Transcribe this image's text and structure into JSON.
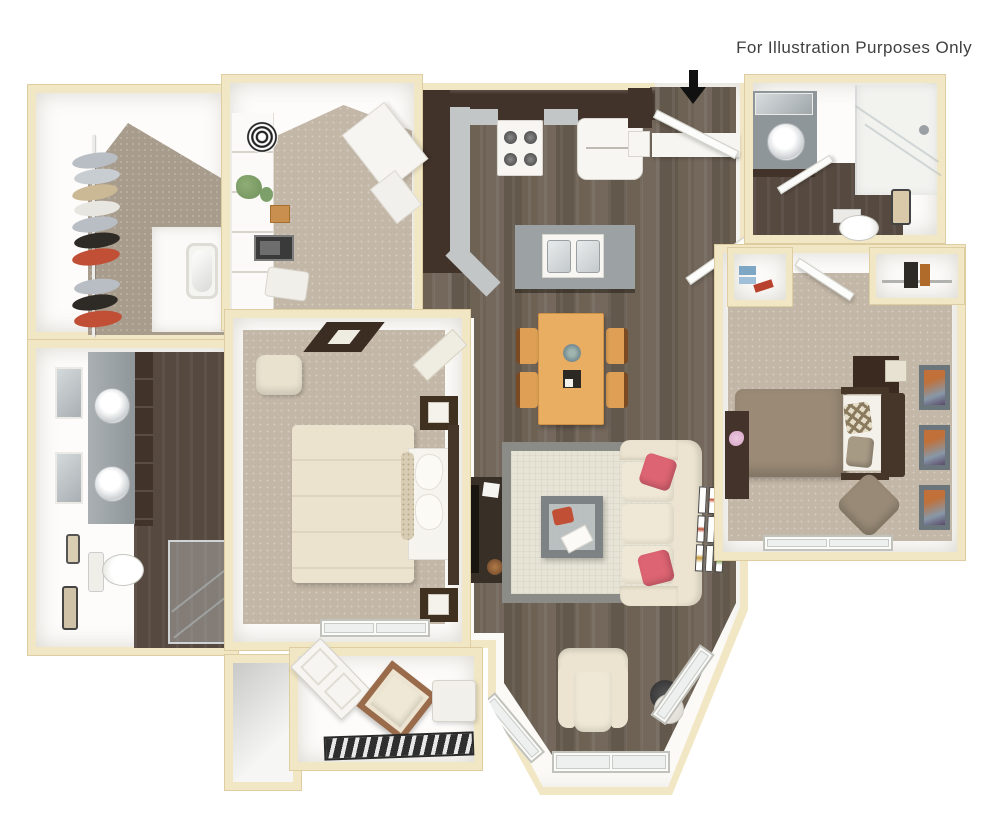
{
  "caption": {
    "text": "For Illustration Purposes Only"
  },
  "palette": {
    "wall": "#f2e7c5",
    "wall_edge": "#ddcda0",
    "wood": "#6e6255",
    "bath_floor": "#564940",
    "carpet": "#c3b7a7",
    "carpet_dark": "#a89c8d",
    "cabinet": "#41332a",
    "counter": "#c3c6c6",
    "island": "#9ca1a4",
    "steel": "#8f969a",
    "table_wood": "#e9ae62",
    "chair_wood": "#dfa055",
    "sofa": "#ece4d0",
    "cushion": "#efe8d6",
    "pillow": "#dd6472",
    "rug_field": "#e7e4d6",
    "rug_border": "#8b8b87",
    "bed1": "#ece3cf",
    "bed2": "#9a8a76",
    "head_dark": "#46362a",
    "frame": "#6b757c",
    "art": "#c07038",
    "accent_red": "#c14f35",
    "plant": "#6f8f5a",
    "mat_dark": "#2f2f2f",
    "arrow_black": "#111111",
    "text": "#3f3f3f"
  },
  "scene": {
    "type": "3d-floor-plan",
    "rooms": [
      "walk-in-closet",
      "bathroom-main",
      "den",
      "kitchen",
      "entry-hall",
      "bathroom-2",
      "linen-closet",
      "reach-in-closet",
      "master-bedroom",
      "bedroom-2",
      "dining-area",
      "living-room",
      "bay-window",
      "patio",
      "storage-closet"
    ],
    "furniture": [
      "hanging-clothes",
      "double-vanity",
      "toilet",
      "shower",
      "bathtub",
      "shelving-unit",
      "microwave",
      "desk",
      "range-stove",
      "refrigerator",
      "kitchen-island-sink",
      "dining-table",
      "dining-chairs",
      "sofa",
      "coffee-table",
      "area-rug",
      "tv-console",
      "armchair",
      "floor-lamp",
      "queen-bed",
      "nightstands",
      "ceiling-fan",
      "dresser",
      "full-bed",
      "ottoman-chair",
      "wall-art",
      "patio-chair",
      "side-table",
      "door-mat",
      "entry-arrow"
    ]
  }
}
